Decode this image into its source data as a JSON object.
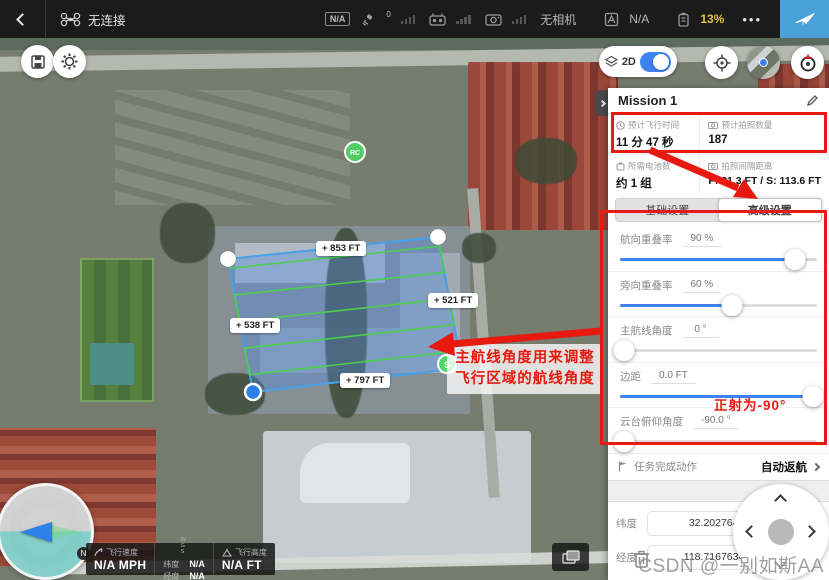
{
  "colors": {
    "accent": "#3c82f0",
    "annotation": "#e8190f",
    "battery": "#e6c23a",
    "takeoff_bg": "#4aa0d8",
    "polygon_line": "#45a1e8",
    "flight_line": "#4ad04a"
  },
  "topbar": {
    "connection_status": "无连接",
    "gps_mode_badge": "N/A",
    "satellite_count": "0",
    "no_camera": "无相机",
    "flight_mode": "N/A",
    "battery": "13%",
    "more": "•••"
  },
  "map": {
    "view_mode": "2D",
    "compass_north": "N",
    "rc_marker": "RC",
    "start_marker": "S",
    "distance_labels": [
      {
        "text": "+ 853 FT"
      },
      {
        "text": "+ 521 FT"
      },
      {
        "text": "+ 538 FT"
      },
      {
        "text": "+ 797 FT"
      }
    ]
  },
  "telemetry": {
    "speed_label": "飞行速度",
    "speed_value": "N/A MPH",
    "wgs": "WGS",
    "lat_label": "纬度",
    "lat_value": "N/A",
    "lng_label": "经度",
    "lng_value": "N/A",
    "alt_label": "飞行高度",
    "alt_value": "N/A FT"
  },
  "panel": {
    "title": "Mission 1",
    "stats": [
      {
        "label": "预计飞行时间",
        "value": "11 分 47 秒"
      },
      {
        "label": "预计拍照数量",
        "value": "187"
      },
      {
        "label": "所需电池数",
        "value": "约 1 组"
      },
      {
        "label": "拍照间隔距离",
        "value": "F: 21.3 FT / S: 113.6 FT"
      }
    ],
    "tabs": {
      "basic": "基础设置",
      "advanced": "高级设置"
    },
    "settings": [
      {
        "label": "航向重叠率",
        "value": "90 %",
        "fill": 89
      },
      {
        "label": "旁向重叠率",
        "value": "60 %",
        "fill": 57
      },
      {
        "label": "主航线角度",
        "value": "0 °",
        "fill": 2
      },
      {
        "label": "边距",
        "value": "0.0 FT",
        "fill": 98
      },
      {
        "label": "云台俯仰角度",
        "value": "-90.0 °",
        "fill": 2
      }
    ],
    "finish_action": {
      "label": "任务完成动作",
      "value": "自动返航"
    },
    "coords": {
      "lat_label": "纬度",
      "lat_value": "32.202764195",
      "lng_label": "经度",
      "lng_value": "118.716763493"
    }
  },
  "annotations": {
    "note_line1": "主航线角度用来调整",
    "note_line2": "飞行区域的航线角度",
    "gimbal_note": "正射为-90°"
  },
  "watermark": "CSDN @一别如斯AA"
}
